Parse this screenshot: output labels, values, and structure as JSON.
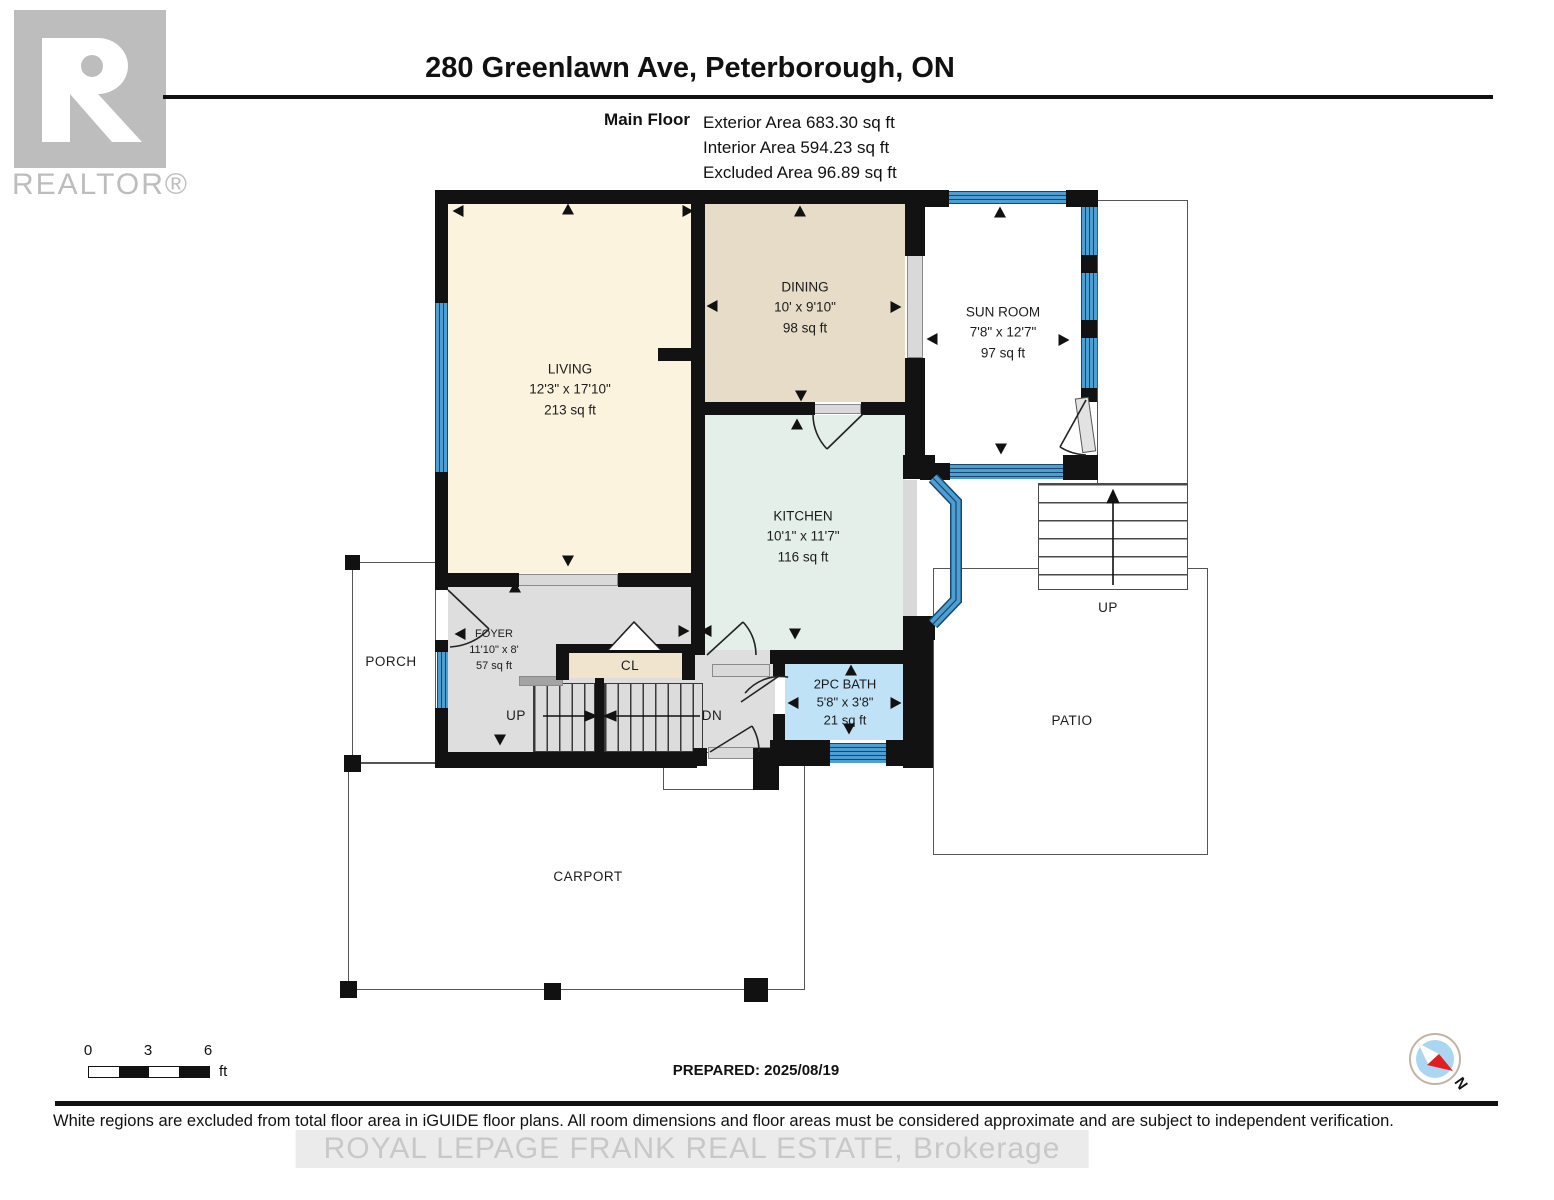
{
  "header": {
    "title": "280 Greenlawn Ave, Peterborough, ON",
    "floor_label": "Main Floor",
    "areas": [
      "Exterior Area 683.30 sq ft",
      "Interior Area 594.23 sq ft",
      "Excluded Area 96.89 sq ft"
    ],
    "logo_brand": "REALTOR®"
  },
  "rooms": {
    "living": {
      "name": "LIVING",
      "dims": "12'3\" x 17'10\"",
      "area": "213 sq ft"
    },
    "dining": {
      "name": "DINING",
      "dims": "10' x 9'10\"",
      "area": "98 sq ft"
    },
    "kitchen": {
      "name": "KITCHEN",
      "dims": "10'1\" x 11'7\"",
      "area": "116 sq ft"
    },
    "sunroom": {
      "name": "SUN ROOM",
      "dims": "7'8\" x 12'7\"",
      "area": "97 sq ft"
    },
    "foyer": {
      "name": "FOYER",
      "dims": "11'10\" x 8'",
      "area": "57 sq ft"
    },
    "bath": {
      "name": "2PC BATH",
      "dims": "5'8\" x 3'8\"",
      "area": "21 sq ft"
    },
    "closet_label": "CL",
    "porch_label": "PORCH",
    "patio_label": "PATIO",
    "carport_label": "CARPORT",
    "stairs_up_label": "UP",
    "stairs_dn_label": "DN",
    "exterior_stairs_label": "UP"
  },
  "scale_bar": {
    "ticks": [
      "0",
      "3",
      "6"
    ],
    "unit": "ft"
  },
  "prepared": "PREPARED: 2025/08/19",
  "compass": {
    "label": "N"
  },
  "footer": {
    "disclaimer": "White regions are excluded from total floor area in iGUIDE floor plans. All room dimensions and floor areas must be considered approximate and are subject to independent verification.",
    "watermark": "ROYAL LEPAGE FRANK REAL ESTATE, Brokerage"
  },
  "colors": {
    "wall": "#121212",
    "window_blue": "#4d9fd3",
    "living_fill": "#fbf3de",
    "dining_fill": "#e6dcc8",
    "kitchen_fill": "#e3efe8",
    "foyer_fill": "#dedede",
    "bath_fill": "#bfe2f7",
    "closet_fill": "#f0e4cf",
    "logo_gray": "#bdbdbd",
    "compass_inner": "#aad6f2",
    "compass_needle_red": "#e02020"
  }
}
